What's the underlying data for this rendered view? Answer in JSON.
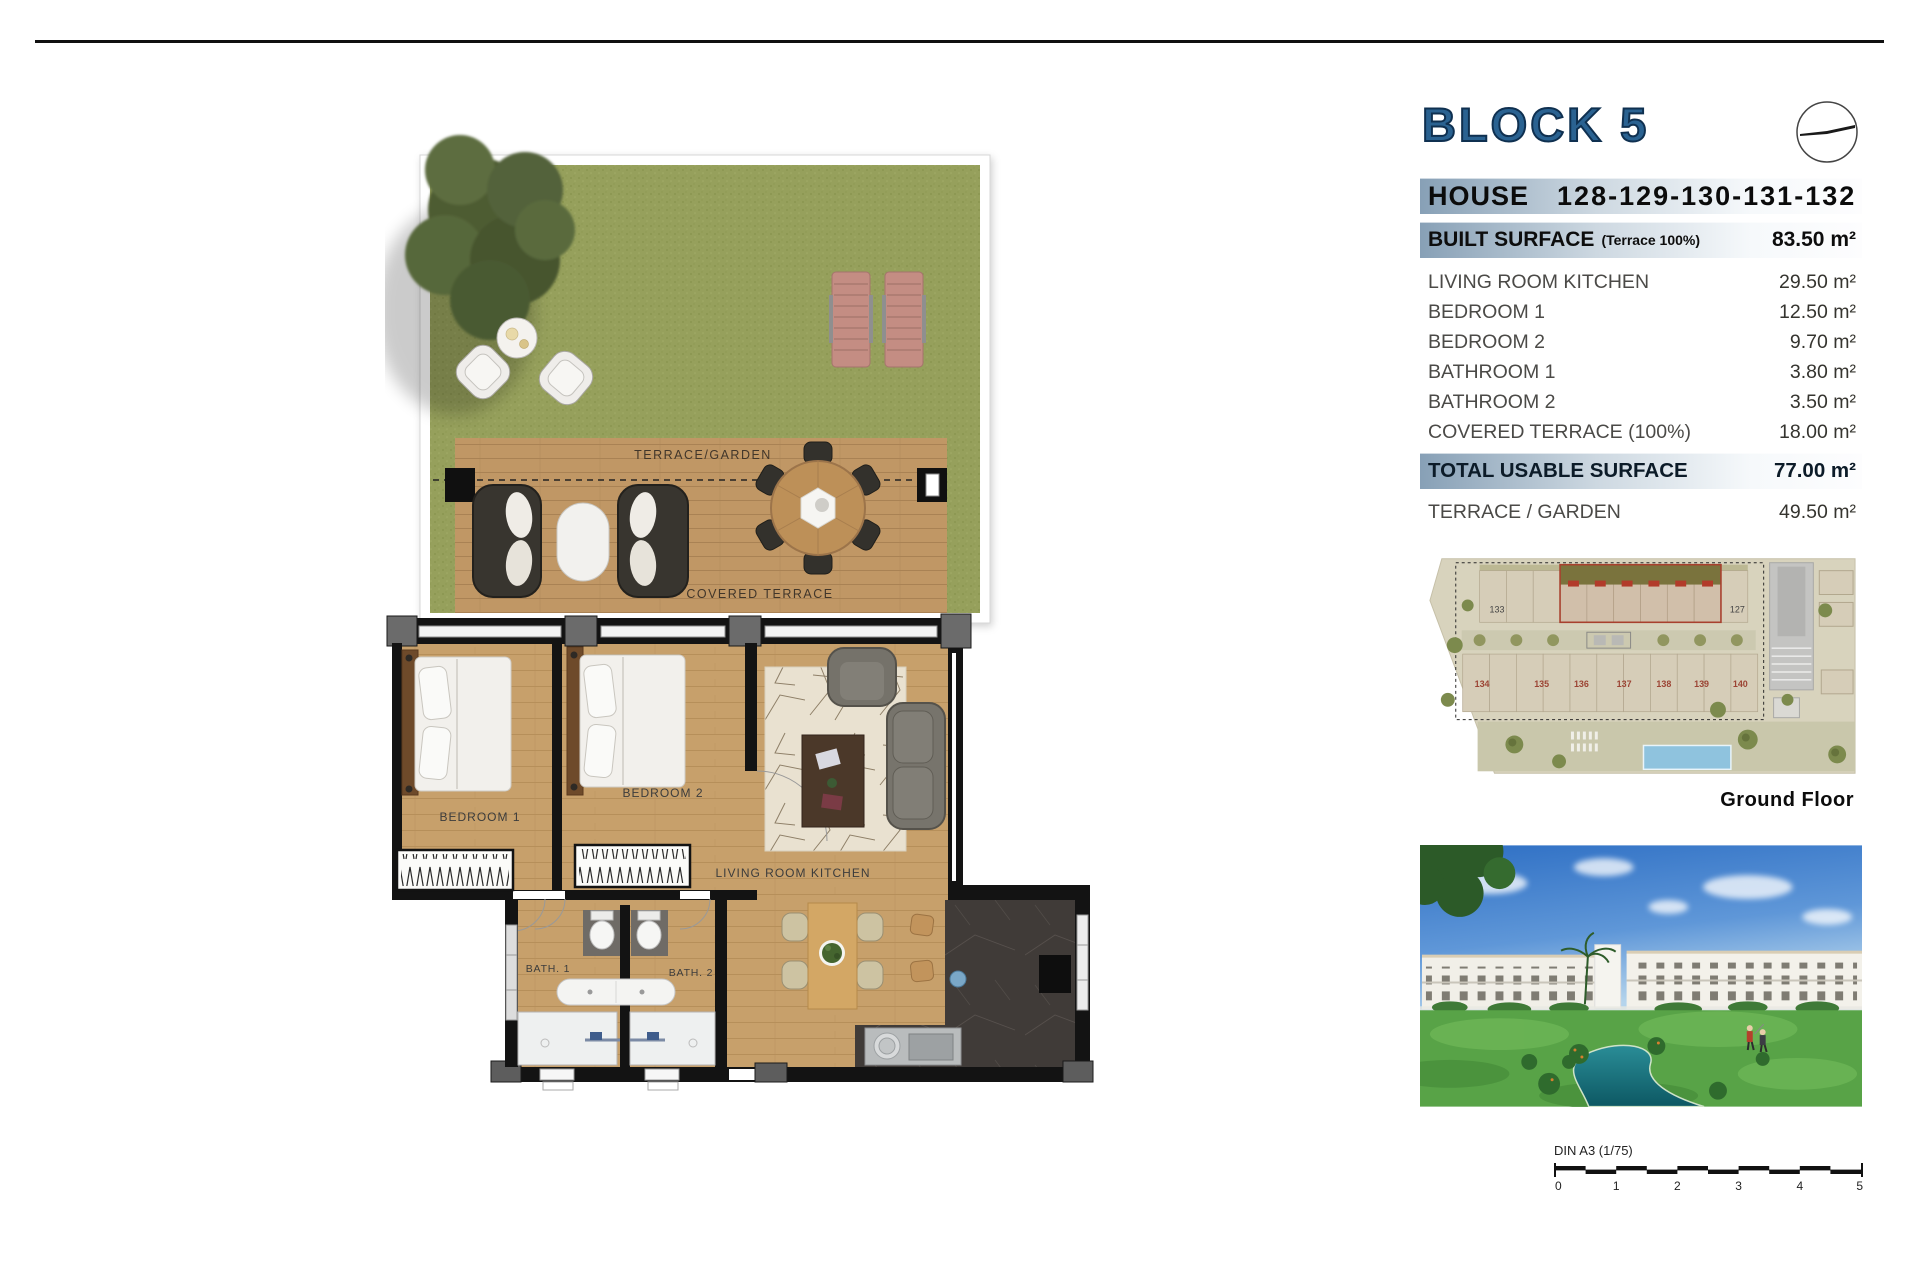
{
  "header": {
    "block_title": "BLOCK 5",
    "house_label": "HOUSE",
    "house_numbers": "128-129-130-131-132"
  },
  "surface_table": {
    "built_label": "BUILT SURFACE",
    "built_note": "(Terrace 100%)",
    "built_value": "83.50 m²",
    "rows": [
      {
        "label": "LIVING ROOM KITCHEN",
        "value": "29.50 m²"
      },
      {
        "label": "BEDROOM 1",
        "value": "12.50 m²"
      },
      {
        "label": "BEDROOM 2",
        "value": "9.70 m²"
      },
      {
        "label": "BATHROOM 1",
        "value": "3.80 m²"
      },
      {
        "label": "BATHROOM 2",
        "value": "3.50 m²"
      },
      {
        "label": "COVERED TERRACE (100%)",
        "value": "18.00 m²"
      }
    ],
    "total_label": "TOTAL USABLE SURFACE",
    "total_value": "77.00 m²",
    "terrace_label": "TERRACE / GARDEN",
    "terrace_value": "49.50 m²"
  },
  "floor_plan": {
    "labels": {
      "terrace_garden": "TERRACE/GARDEN",
      "covered_terrace": "COVERED TERRACE",
      "bedroom1": "BEDROOM 1",
      "bedroom2": "BEDROOM 2",
      "living": "LIVING ROOM KITCHEN",
      "bath1": "BATH. 1",
      "bath2": "BATH. 2"
    }
  },
  "site_plan": {
    "caption": "Ground Floor",
    "unit_top_left": "133",
    "unit_top_right": "127",
    "units_bottom": [
      "134",
      "135",
      "136",
      "137",
      "138",
      "139",
      "140"
    ]
  },
  "scale_bar": {
    "label": "DIN A3 (1/75)",
    "ticks": [
      "0",
      "1",
      "2",
      "3",
      "4",
      "5"
    ]
  },
  "colors": {
    "title_blue": "#20567f",
    "bar_blue": "#87a0b6",
    "grass_green": "#96a05c",
    "wood": "#c7a06b",
    "wall_black": "#131313",
    "highlight_red": "#a8402e",
    "pool_blue": "#8fc3de",
    "sky_blue": "#3276c9",
    "golf_green": "#58a347",
    "river_teal": "#17707e"
  }
}
